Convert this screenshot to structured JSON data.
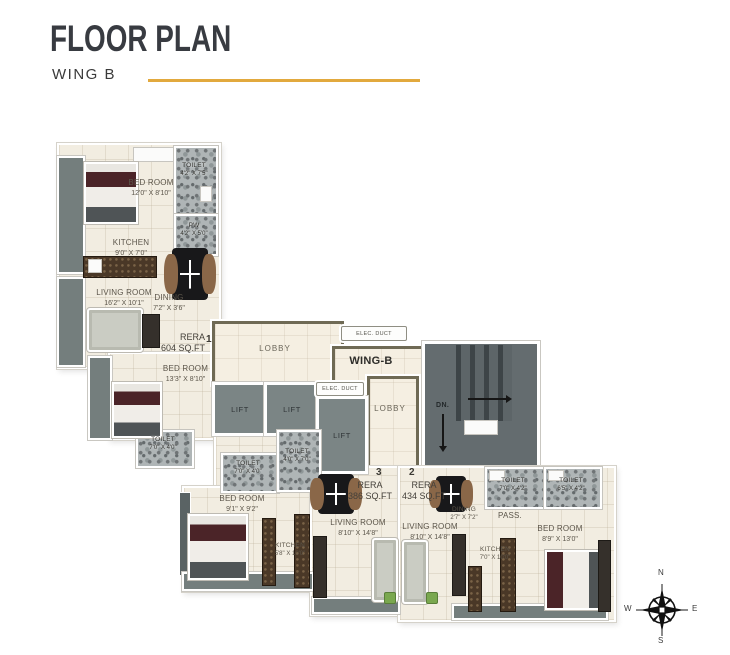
{
  "header": {
    "title": "FLOOR PLAN",
    "subtitle": "WING B"
  },
  "plan": {
    "wing_label": "WING-B",
    "core": {
      "lobby_main": "LOBBY",
      "lobby_side": "LOBBY",
      "elec_duct_top": "ELEC. DUCT",
      "elec_duct_mid": "ELEC. DUCT",
      "lift": "LIFT",
      "stairs_down": "DN."
    },
    "units": [
      {
        "number": "1",
        "rera_line1": "RERA",
        "rera_line2": "604 SQ.FT"
      },
      {
        "number": "2",
        "rera_line1": "RERA",
        "rera_line2": "434 SQ.FT"
      },
      {
        "number": "3",
        "rera_line1": "RERA",
        "rera_line2": "386 SQ.FT"
      }
    ],
    "rooms": {
      "u1_bedroom": {
        "name": "BED ROOM",
        "dims": "12'0\" X 8'10\""
      },
      "u1_toilet": {
        "name": "TOILET",
        "dims": "4'2\" X 7'5\""
      },
      "u1_pw": {
        "name": "PW",
        "dims": "4'2\" X 5'0\""
      },
      "u1_kitchen": {
        "name": "KITCHEN",
        "dims": "9'0\" X 7'0\""
      },
      "u1_living": {
        "name": "LIVING ROOM",
        "dims": "16'2\" X 10'1\""
      },
      "u1_dining": {
        "name": "DINING",
        "dims": "7'2\" X 3'6\""
      },
      "u1_bedroom2": {
        "name": "BED ROOM",
        "dims": "13'3\" X 8'10\""
      },
      "u1_toilet2": {
        "name": "TOILET",
        "dims": "7'0\" X 4'0\""
      },
      "u3_toilet_a": {
        "name": "TOILET",
        "dims": "7'0\" X 4'0\""
      },
      "u3_toilet_b": {
        "name": "TOILET",
        "dims": "4'0\" X 7'0\""
      },
      "u3_bedroom": {
        "name": "BED ROOM",
        "dims": "9'1\" X 9'2\""
      },
      "u3_kitchen": {
        "name": "KITCHEN",
        "dims": "5'8\" X 10'0\""
      },
      "u3_living": {
        "name": "LIVING ROOM",
        "dims": "8'10\" X 14'8\""
      },
      "u2_living": {
        "name": "LIVING ROOM",
        "dims": "8'10\" X 14'8\""
      },
      "u2_dining": {
        "name": "DINING",
        "dims": "2'7\" X 7'2\""
      },
      "u2_pass": {
        "name": "PASS."
      },
      "u2_toilet_a": {
        "name": "TOILET",
        "dims": "7'0\" X 4'2\""
      },
      "u2_toilet_b": {
        "name": "TOILET",
        "dims": "6'5\" X 4'2\""
      },
      "u2_kitchen": {
        "name": "KITCHEN",
        "dims": "7'0\" X 10'0\""
      },
      "u2_bedroom": {
        "name": "BED ROOM",
        "dims": "8'9\" X 13'0\""
      }
    },
    "compass": {
      "north": "N",
      "east": "E",
      "south": "S",
      "west": "W"
    }
  },
  "colors": {
    "accent_line": "#E2A93E",
    "floor": "#F2EDE1",
    "slate": "#747E7D",
    "lobby_border": "#6F6A55",
    "wall": "#FFFFFF"
  }
}
